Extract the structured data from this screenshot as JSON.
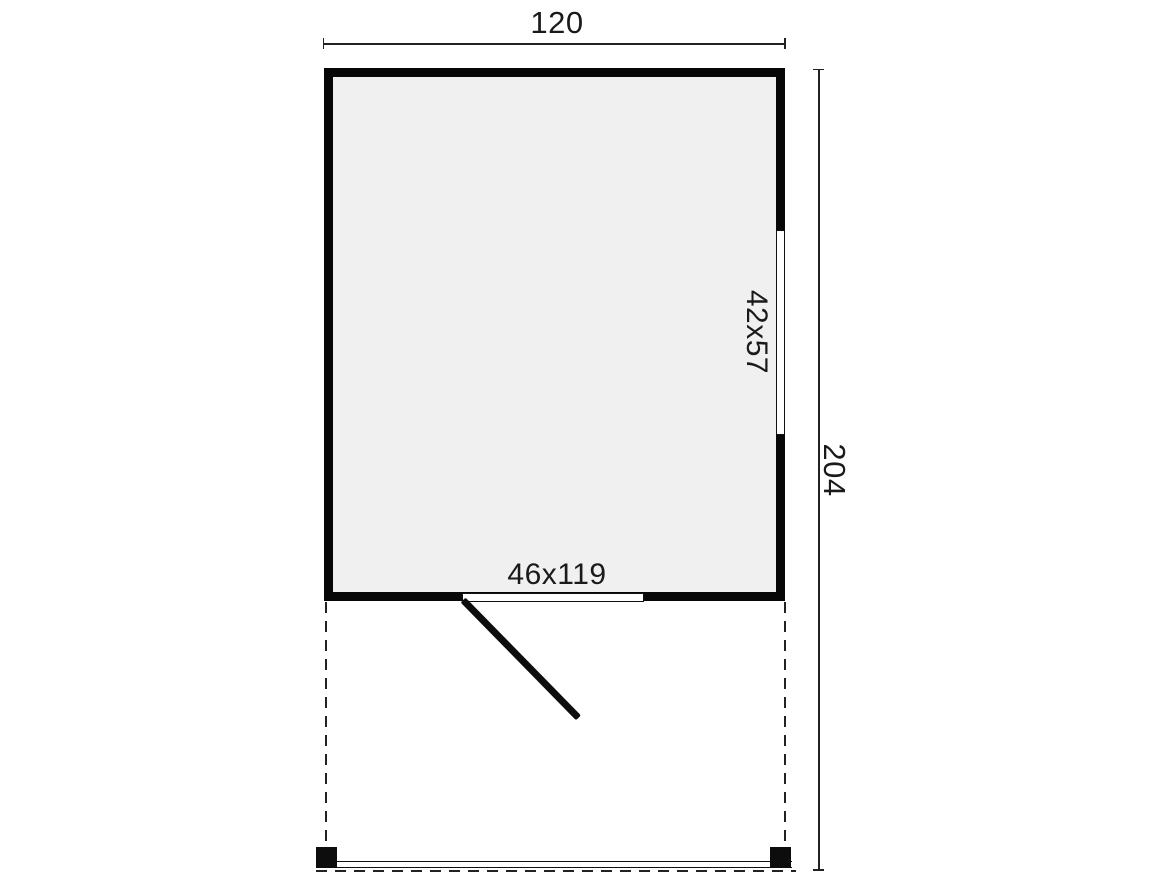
{
  "diagram": {
    "type": "floor-plan",
    "room": {
      "width_label": "120",
      "depth_label": "204"
    },
    "window": {
      "size_label": "42x57"
    },
    "door": {
      "size_label": "46x119"
    },
    "colors": {
      "wall": "#070707",
      "room_fill": "#f0f0f0",
      "line": "#222222",
      "text": "#1a1a1a",
      "background": "#ffffff"
    }
  }
}
